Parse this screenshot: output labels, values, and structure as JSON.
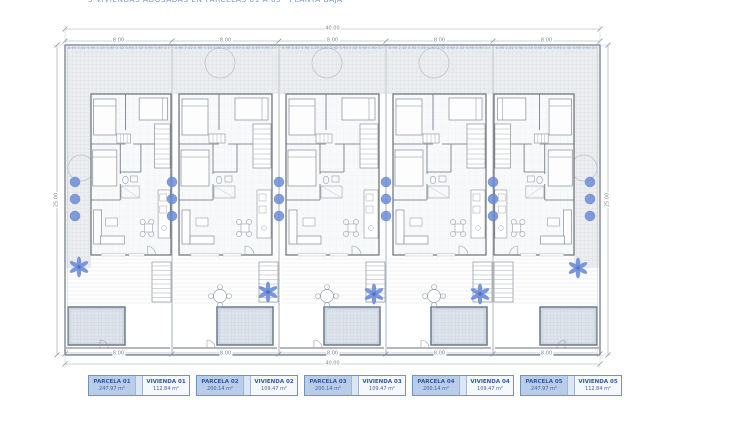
{
  "title": {
    "text": "5 VIVIENDAS ADOSADAS EN PARCELAS 01 A 05 · PLANTA BAJA"
  },
  "colors": {
    "accent_blue": "#6b8cd8",
    "wall_line": "#6a7078",
    "dimension_line": "#9aa2ac",
    "label_border": "#6f94c4",
    "label_fill": "#b9cde9",
    "label_gap_fill": "#dce7f5",
    "label_text": "#2f55a0",
    "pool_border": "#5f7183"
  },
  "dimensions": {
    "top_total": "40.00",
    "bottom_total": "40.00",
    "left_side": "25.00",
    "right_side": "25.00",
    "top_segments": [
      "8.00",
      "8.00",
      "8.00",
      "8.00",
      "8.00"
    ],
    "bottom_segments": [
      "8.00",
      "8.00",
      "8.00",
      "8.00",
      "8.00"
    ],
    "micro_annotations": "0.90 2.42 0.90 1.20 0.90 2.42 0.90 2.42 0.90"
  },
  "parcels": [
    {
      "type": "end-left",
      "parcel_label": "PARCELA 01",
      "parcel_area": "247.97 m²",
      "house_label": "VIVIENDA 01",
      "house_area": "112.84 m²"
    },
    {
      "type": "middle",
      "parcel_label": "PARCELA 02",
      "parcel_area": "200.14 m²",
      "house_label": "VIVIENDA 02",
      "house_area": "109.47 m²"
    },
    {
      "type": "middle",
      "parcel_label": "PARCELA 03",
      "parcel_area": "200.14 m²",
      "house_label": "VIVIENDA 03",
      "house_area": "109.47 m²"
    },
    {
      "type": "middle",
      "parcel_label": "PARCELA 04",
      "parcel_area": "200.14 m²",
      "house_label": "VIVIENDA 04",
      "house_area": "109.47 m²"
    },
    {
      "type": "end-right",
      "parcel_label": "PARCELA 05",
      "parcel_area": "247.97 m²",
      "house_label": "VIVIENDA 05",
      "house_area": "112.84 m²"
    }
  ]
}
